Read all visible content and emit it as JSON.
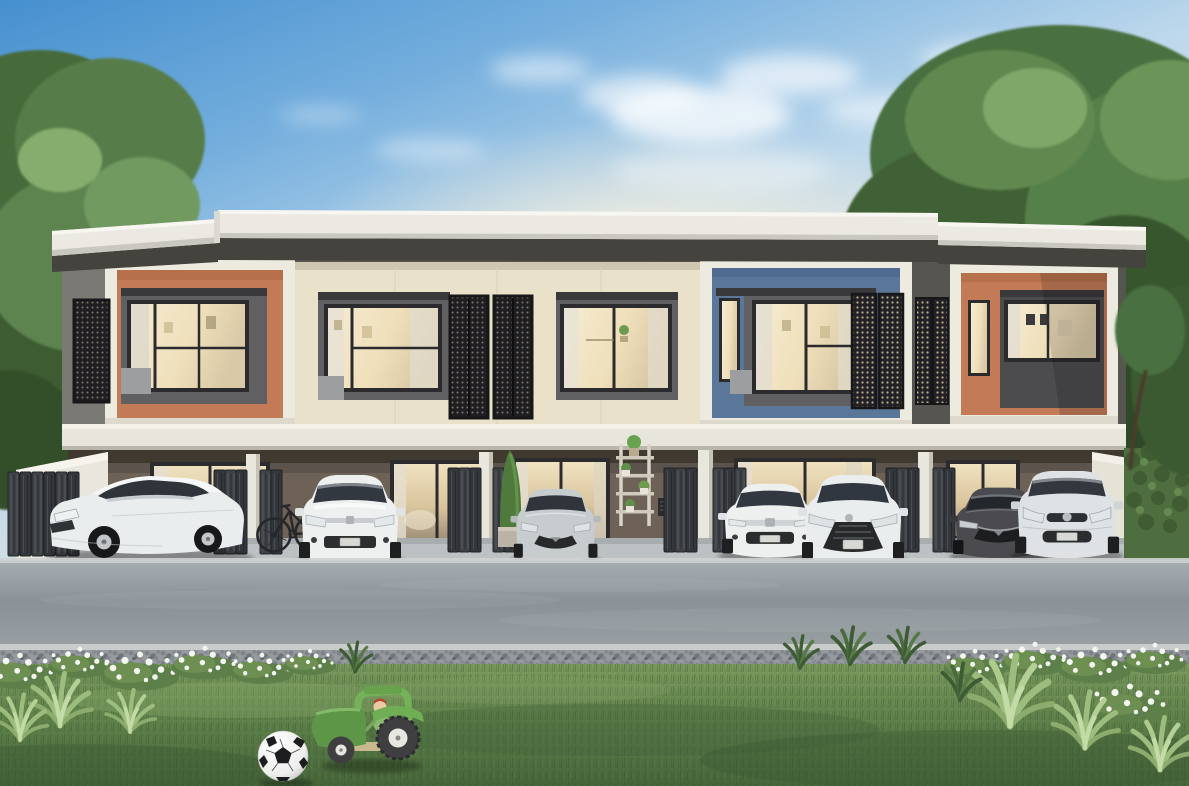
{
  "image": {
    "width": 1189,
    "height": 786,
    "kind": "Photorealistic rendering of a modern two-storey townhouse row with carports, parked cars, lawn and toys",
    "text_content": "none"
  },
  "palette": {
    "sky_top": "#4690cf",
    "sky_mid": "#bdd8ec",
    "sky_warm": "#f2ead9",
    "cloud": "#ffffff",
    "tree_dark": "#3c5c33",
    "tree_mid": "#577d49",
    "tree_light": "#7fa263",
    "roof_fascia": "#ebe9e1",
    "roof_eave": "#45433e",
    "facade_dark": "#57554f",
    "facade_cream": "#e9e1ca",
    "frame_white": "#edeae0",
    "panel_orange": "#c27a57",
    "panel_blue": "#5a7699",
    "panel_gray": "#606062",
    "panel_gray_light": "#9c9ea0",
    "window_frame": "#2b2b2e",
    "window_lit": "#f3e7cb",
    "awning_dark": "#39393b",
    "mesh_dark": "#1f1f23",
    "beam_white": "#e8e5dc",
    "carport_wall": "#6e6257",
    "carport_lintel": "#40392f",
    "column_white": "#e9e6dd",
    "gate_metal": "#3e4145",
    "glass_warm": "#e9d9b4",
    "floor_concrete": "#bcc1c3",
    "road_gray": "#99a2a7",
    "curb": "#c9cccb",
    "grass_top": "#7a9a5e",
    "grass_bottom": "#46663a",
    "plant_pale": "#9dbd7e",
    "flower_white": "#f4f6f0",
    "ball_white": "#f4f4f2",
    "ball_black": "#1d1d1f",
    "toy_green": "#67a24c",
    "toy_green_dark": "#5d9646",
    "toy_wheel": "#3f3f41",
    "bike_dark": "#26272a",
    "trunk_brown": "#513f2f"
  },
  "scene": {
    "sky": {
      "condition": "clear blue fading to warm haze, wispy clouds"
    },
    "building": {
      "storeys": 2,
      "style": "modern flat-roof townhome row with white box frames",
      "units": [
        {
          "index": 1,
          "accent": "terracotta",
          "accent_panel": "#c27a57"
        },
        {
          "index": 2,
          "accent": "cream",
          "accent_panel": "#e9e1ca"
        },
        {
          "index": 3,
          "accent": "cream",
          "accent_panel": "#e9e1ca"
        },
        {
          "index": 4,
          "accent": "blue",
          "accent_panel": "#5a7699"
        },
        {
          "index": 5,
          "accent": "terracotta",
          "accent_panel": "#c27a57"
        }
      ],
      "features": [
        "dark mesh privacy screens",
        "lit windows",
        "white floor beam",
        "carports",
        "folding metal gates",
        "sliding glass doors",
        "plant ladder shelf",
        "vent grille",
        "potted shrub"
      ]
    },
    "vehicles": [
      {
        "slot": 1,
        "type": "white sedan (three-quarter view)",
        "color": "#e9edee"
      },
      {
        "slot": 2,
        "type": "white hatchback",
        "color": "#eef0f0"
      },
      {
        "slot": 3,
        "type": "silver hatchback",
        "color": "#c7cccf"
      },
      {
        "slot": 4,
        "type": "white sedan",
        "color": "#eef0f0"
      },
      {
        "slot": 5,
        "type": "white compact",
        "color": "#e9edee"
      },
      {
        "slot": 6,
        "type": "dark gray sedan",
        "color": "#4b4a4e"
      },
      {
        "slot": 7,
        "type": "silver compact",
        "color": "#dfe2e4"
      }
    ],
    "bicycle_count": 1,
    "foreground": {
      "road": "asphalt street",
      "edge": "gravel strip with light curb",
      "lawn": "green grass verge",
      "plants": [
        "white flower beds",
        "spiky succulents",
        "grass tufts",
        "hedge on right"
      ],
      "toys": [
        "soccer ball",
        "green toy tractor with rider figure"
      ]
    }
  }
}
